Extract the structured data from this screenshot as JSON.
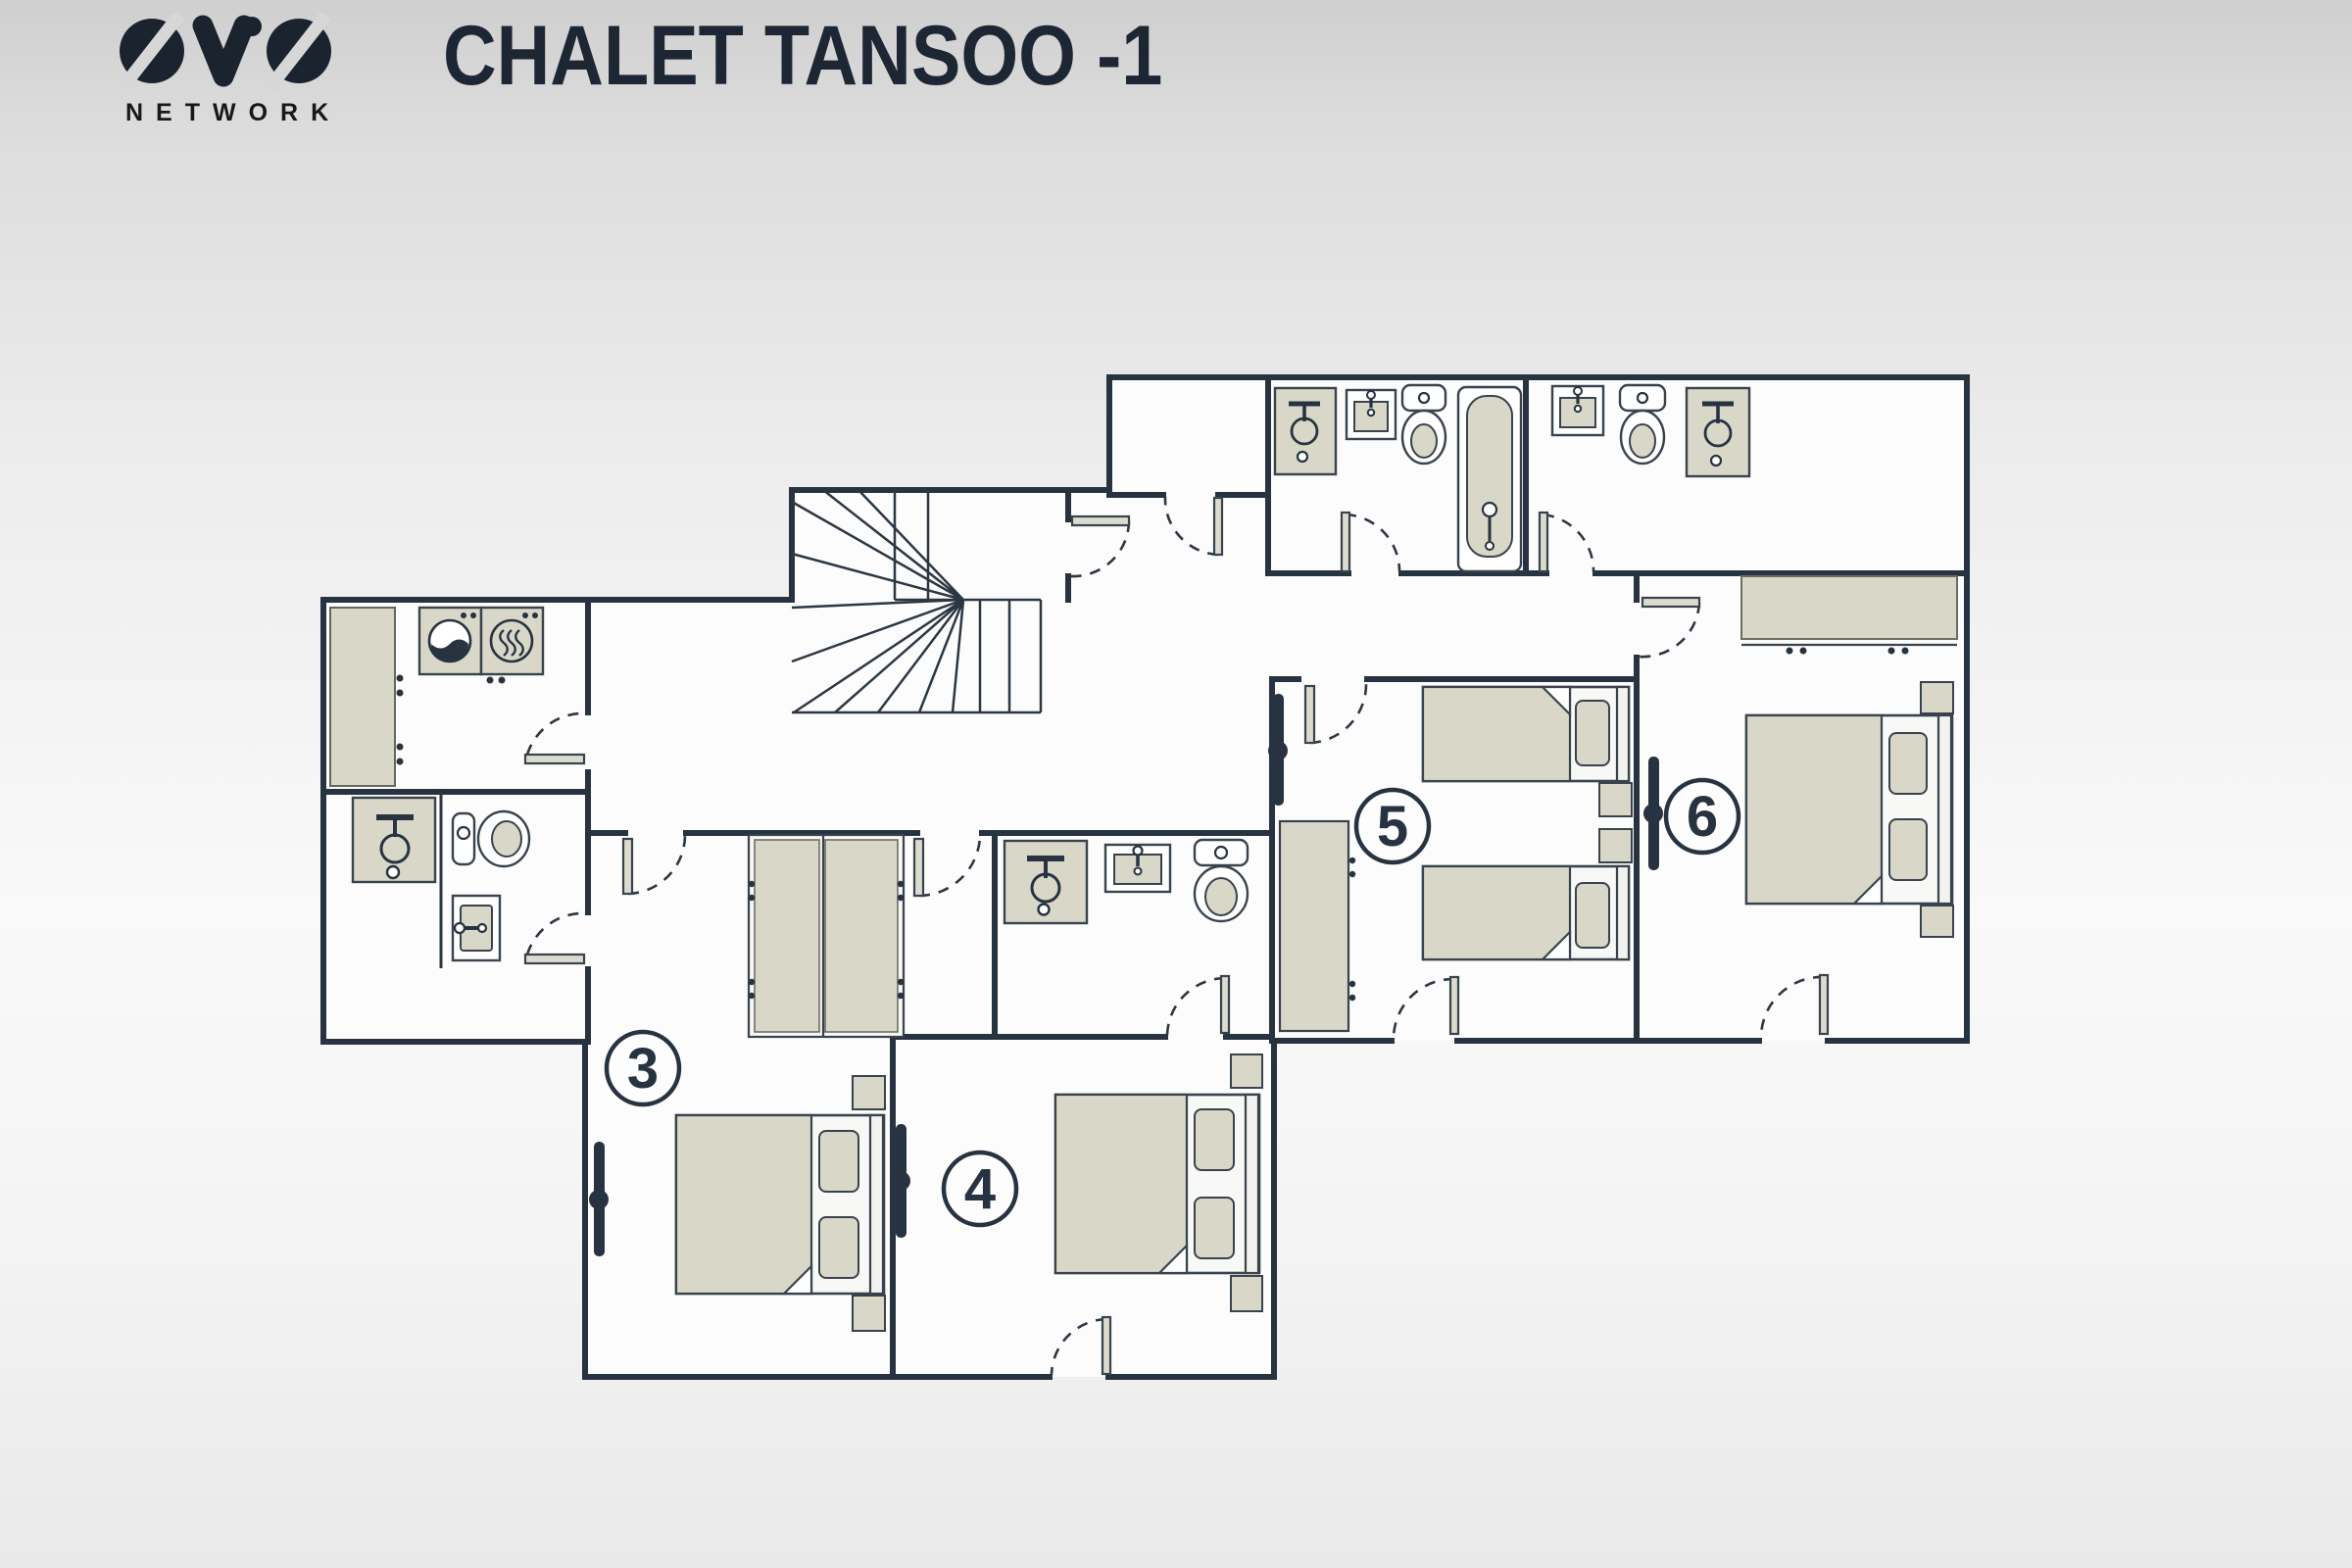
{
  "header": {
    "brand": {
      "name": "OVO",
      "subtext": "NETWORK"
    },
    "title": "CHALET TANSOO -1"
  },
  "floor_label": "-1",
  "rooms": [
    {
      "id": "room-3",
      "number": "3",
      "type": "double-bedroom"
    },
    {
      "id": "room-4",
      "number": "4",
      "type": "double-bedroom"
    },
    {
      "id": "room-5",
      "number": "5",
      "type": "twin-bedroom"
    },
    {
      "id": "room-6",
      "number": "6",
      "type": "double-bedroom"
    }
  ],
  "fixtures_present": [
    "staircase",
    "washing-machine",
    "tumble-dryer",
    "laundry-counter",
    "shower",
    "washbasin",
    "toilet",
    "bathtub",
    "double-bed",
    "single-bed",
    "pillow",
    "nightstand",
    "wardrobe",
    "wall-tv",
    "door",
    "door-swing-arc"
  ],
  "colors": {
    "wall": "#273340",
    "fixture_fill": "#d9d8c8",
    "floor": "#fcfcfd",
    "background_top": "#cfcfcf",
    "text": "#1d2733"
  }
}
